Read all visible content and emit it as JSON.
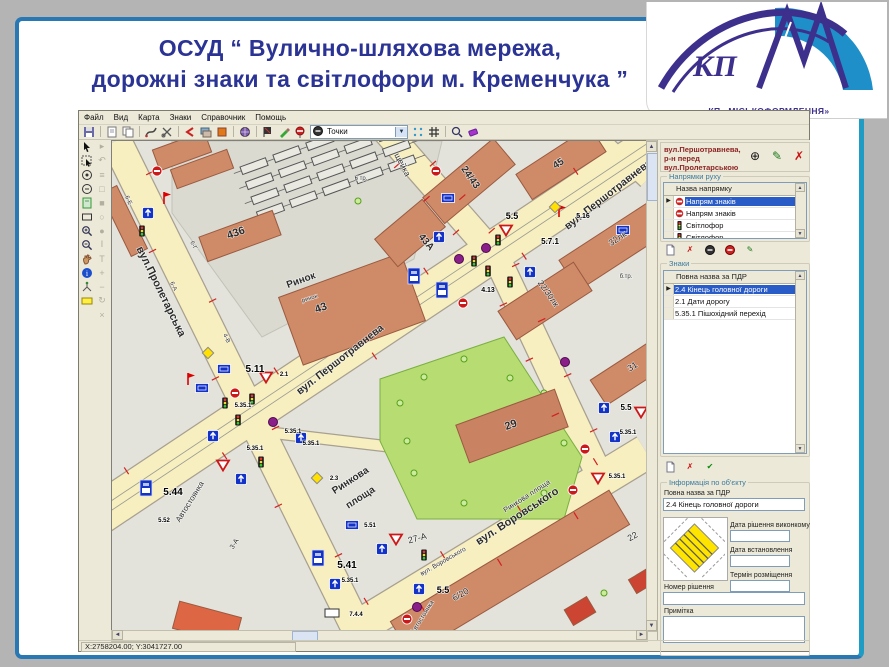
{
  "slide": {
    "title_line1": "ОСУД “ Вулично-шляхова мережа,",
    "title_line2": "дорожні знаки та світлофори м. Кременчука ”"
  },
  "logo": {
    "kp": "КП",
    "caption": "КП «МІСЬКОФОРМЛЕННЯ»",
    "purple": "#3d2f8c",
    "blue": "#1f8fc9"
  },
  "app": {
    "menu": [
      "Файл",
      "Вид",
      "Карта",
      "Знаки",
      "Справочник",
      "Помощь"
    ],
    "toolbar": {
      "combo_value": "Точки"
    },
    "statusbar": "X:2758204.00; Y:3041727.00",
    "panel": {
      "header": "вул.Першотравнева, р-н перед вул.Пролетарською",
      "directions": {
        "group_label": "Напрямки руху",
        "column": "Назва напрямку",
        "rows": [
          {
            "icon": "no-entry",
            "label": "Напрям знаків",
            "selected": true
          },
          {
            "icon": "no-entry",
            "label": "Напрям знаків",
            "selected": false
          },
          {
            "icon": "traffic-light",
            "label": "Світлофор",
            "selected": false
          },
          {
            "icon": "traffic-light",
            "label": "Світлофор",
            "selected": false
          }
        ]
      },
      "signs": {
        "group_label": "Знаки",
        "column": "Повна назва за ПДР",
        "rows": [
          {
            "icon": "",
            "label": "2.4 Кінець головної дороги",
            "selected": true
          },
          {
            "icon": "",
            "label": "2.1 Дати дорогу",
            "selected": false
          },
          {
            "icon": "",
            "label": "5.35.1 Пішохідний перехід",
            "selected": false
          }
        ]
      },
      "info": {
        "group_label": "Інформація по об'єкту",
        "full_name_label": "Повна назва за ПДР",
        "full_name_value": "2.4 Кінець головної дороги",
        "date_fields": [
          {
            "label": "Дата рішення виконкому",
            "value": ""
          },
          {
            "label": "Дата встановлення",
            "value": ""
          },
          {
            "label": "Термін розміщення",
            "value": ""
          }
        ],
        "decision_label": "Номер рішення",
        "decision_value": "",
        "note_label": "Примітка",
        "note_value": ""
      }
    },
    "map": {
      "street_labels": [
        {
          "text": "вул. Першотравнева",
          "x": 498,
          "y": 56,
          "rot": -38,
          "size": 10.5
        },
        {
          "text": "вул. Першотравнева",
          "x": 230,
          "y": 221,
          "rot": -38,
          "size": 10.5
        },
        {
          "text": "вул.Пролетарська",
          "x": 46,
          "y": 152,
          "rot": 64,
          "size": 11
        },
        {
          "text": "щейка",
          "x": 288,
          "y": 25,
          "rot": 62,
          "size": 8.5
        },
        {
          "text": "вул. Воровського",
          "x": 407,
          "y": 378,
          "rot": -33,
          "size": 11
        },
        {
          "text": "вул. Воровського",
          "x": 332,
          "y": 422,
          "rot": -30,
          "size": 6.5
        }
      ],
      "area_labels": [
        {
          "text": "436",
          "x": 125,
          "y": 95,
          "rot": -20,
          "size": 11
        },
        {
          "text": "Ринок",
          "x": 190,
          "y": 142,
          "rot": -20,
          "size": 10
        },
        {
          "text": "ринок",
          "x": 198,
          "y": 159,
          "rot": -18,
          "size": 6
        },
        {
          "text": "43",
          "x": 210,
          "y": 170,
          "rot": -20,
          "size": 11
        },
        {
          "text": "43А",
          "x": 312,
          "y": 103,
          "rot": 50,
          "size": 10
        },
        {
          "text": "24/43",
          "x": 356,
          "y": 38,
          "rot": 55,
          "size": 10
        },
        {
          "text": "45",
          "x": 448,
          "y": 25,
          "rot": -33,
          "size": 10
        },
        {
          "text": "32лк",
          "x": 507,
          "y": 100,
          "rot": -33,
          "size": 9
        },
        {
          "text": "22/30лк",
          "x": 434,
          "y": 154,
          "rot": 55,
          "size": 8.5
        },
        {
          "text": "31",
          "x": 522,
          "y": 228,
          "rot": -33,
          "size": 9
        },
        {
          "text": "29",
          "x": 400,
          "y": 287,
          "rot": -20,
          "size": 11
        },
        {
          "text": "27-А",
          "x": 306,
          "y": 400,
          "rot": -15,
          "size": 9
        },
        {
          "text": "6/20",
          "x": 350,
          "y": 456,
          "rot": -30,
          "size": 9
        },
        {
          "text": "22",
          "x": 522,
          "y": 398,
          "rot": -30,
          "size": 9
        },
        {
          "text": "6 тр.",
          "x": 249,
          "y": 39,
          "rot": 0,
          "size": 6
        },
        {
          "text": "б.тр.",
          "x": 514,
          "y": 137,
          "rot": 0,
          "size": 6
        },
        {
          "text": "6-Е",
          "x": 15,
          "y": 60,
          "rot": 64,
          "size": 6
        },
        {
          "text": "6-Г",
          "x": 80,
          "y": 105,
          "rot": 64,
          "size": 6
        },
        {
          "text": "6-А",
          "x": 60,
          "y": 146,
          "rot": 64,
          "size": 6
        },
        {
          "text": "4-В",
          "x": 113,
          "y": 198,
          "rot": 64,
          "size": 6
        },
        {
          "text": "3-А",
          "x": 124,
          "y": 404,
          "rot": -58,
          "size": 7
        },
        {
          "text": "Автостоянка",
          "x": 80,
          "y": 362,
          "rot": -58,
          "size": 8
        },
        {
          "text": "Автостоянка",
          "x": 312,
          "y": 477,
          "rot": -58,
          "size": 6.5
        },
        {
          "text": "Ринкова",
          "x": 240,
          "y": 342,
          "rot": -33,
          "size": 10
        },
        {
          "text": "площа",
          "x": 250,
          "y": 359,
          "rot": -33,
          "size": 10
        },
        {
          "text": "Ринкова площа",
          "x": 416,
          "y": 357,
          "rot": -33,
          "size": 7.5
        }
      ],
      "sign_labels": [
        {
          "text": "5.5",
          "x": 400,
          "y": 78,
          "size": 9
        },
        {
          "text": "5.7.1",
          "x": 438,
          "y": 103,
          "size": 8
        },
        {
          "text": "5.16",
          "x": 471,
          "y": 77,
          "size": 7
        },
        {
          "text": "4.13",
          "x": 376,
          "y": 151,
          "size": 7
        },
        {
          "text": "5.11",
          "x": 143,
          "y": 231,
          "size": 10
        },
        {
          "text": "2.1",
          "x": 172,
          "y": 235,
          "size": 6
        },
        {
          "text": "5.35.1",
          "x": 131,
          "y": 266,
          "size": 6
        },
        {
          "text": "5.35.1",
          "x": 181,
          "y": 292,
          "size": 6
        },
        {
          "text": "5.35.1",
          "x": 199,
          "y": 304,
          "size": 6
        },
        {
          "text": "5.35.1",
          "x": 143,
          "y": 309,
          "size": 6
        },
        {
          "text": "5.41",
          "x": 235,
          "y": 427,
          "size": 10
        },
        {
          "text": "5.35.1",
          "x": 238,
          "y": 441,
          "size": 6
        },
        {
          "text": "7.4.4",
          "x": 244,
          "y": 475,
          "size": 6
        },
        {
          "text": "5.5",
          "x": 331,
          "y": 452,
          "size": 9
        },
        {
          "text": "5.51",
          "x": 258,
          "y": 386,
          "size": 6
        },
        {
          "text": "2.3",
          "x": 222,
          "y": 339,
          "size": 6
        },
        {
          "text": "5.44",
          "x": 61,
          "y": 354,
          "size": 10
        },
        {
          "text": "5.52",
          "x": 52,
          "y": 381,
          "size": 6
        },
        {
          "text": "5.5",
          "x": 514,
          "y": 269,
          "size": 8
        },
        {
          "text": "5.35.1",
          "x": 516,
          "y": 293,
          "size": 6
        },
        {
          "text": "5.35.1",
          "x": 505,
          "y": 337,
          "size": 6
        }
      ],
      "signs": [
        {
          "t": "noentry",
          "x": 324,
          "y": 30
        },
        {
          "t": "bluerect",
          "x": 336,
          "y": 57
        },
        {
          "t": "bluearrow",
          "x": 327,
          "y": 96
        },
        {
          "t": "yield",
          "x": 394,
          "y": 89
        },
        {
          "t": "tlight",
          "x": 386,
          "y": 99
        },
        {
          "t": "tlight",
          "x": 362,
          "y": 120
        },
        {
          "t": "purple",
          "x": 374,
          "y": 107
        },
        {
          "t": "purple",
          "x": 347,
          "y": 118
        },
        {
          "t": "redflag",
          "x": 447,
          "y": 70
        },
        {
          "t": "bluerect",
          "x": 511,
          "y": 89
        },
        {
          "t": "busstop",
          "x": 302,
          "y": 135
        },
        {
          "t": "busstop",
          "x": 330,
          "y": 149
        },
        {
          "t": "noentry",
          "x": 351,
          "y": 162
        },
        {
          "t": "tlight",
          "x": 398,
          "y": 141
        },
        {
          "t": "bluearrow",
          "x": 418,
          "y": 131
        },
        {
          "t": "yellowdiamond",
          "x": 443,
          "y": 66
        },
        {
          "t": "noentry",
          "x": 45,
          "y": 30
        },
        {
          "t": "bluearrow",
          "x": 36,
          "y": 72
        },
        {
          "t": "redflag",
          "x": 52,
          "y": 57
        },
        {
          "t": "tlight",
          "x": 30,
          "y": 90
        },
        {
          "t": "bluerect",
          "x": 112,
          "y": 228
        },
        {
          "t": "bluerect",
          "x": 90,
          "y": 247
        },
        {
          "t": "noentry",
          "x": 123,
          "y": 252
        },
        {
          "t": "yield",
          "x": 154,
          "y": 236
        },
        {
          "t": "tlight",
          "x": 113,
          "y": 262
        },
        {
          "t": "tlight",
          "x": 140,
          "y": 258
        },
        {
          "t": "tlight",
          "x": 126,
          "y": 279
        },
        {
          "t": "purple",
          "x": 161,
          "y": 281
        },
        {
          "t": "bluearrow",
          "x": 189,
          "y": 297
        },
        {
          "t": "bluearrow",
          "x": 101,
          "y": 295
        },
        {
          "t": "tlight",
          "x": 149,
          "y": 321
        },
        {
          "t": "yield",
          "x": 111,
          "y": 324
        },
        {
          "t": "bluearrow",
          "x": 129,
          "y": 338
        },
        {
          "t": "yellowdiamond",
          "x": 96,
          "y": 212
        },
        {
          "t": "redflag",
          "x": 76,
          "y": 238
        },
        {
          "t": "busstop",
          "x": 206,
          "y": 417
        },
        {
          "t": "bluearrow",
          "x": 223,
          "y": 443
        },
        {
          "t": "whiterect",
          "x": 220,
          "y": 472
        },
        {
          "t": "bluearrow",
          "x": 307,
          "y": 448
        },
        {
          "t": "purple",
          "x": 305,
          "y": 466
        },
        {
          "t": "bluerect",
          "x": 240,
          "y": 384
        },
        {
          "t": "yellowdiamond",
          "x": 205,
          "y": 337
        },
        {
          "t": "busstop",
          "x": 34,
          "y": 347
        },
        {
          "t": "tlight",
          "x": 312,
          "y": 414
        },
        {
          "t": "yield",
          "x": 284,
          "y": 398
        },
        {
          "t": "bluearrow",
          "x": 270,
          "y": 408
        },
        {
          "t": "noentry",
          "x": 295,
          "y": 478
        },
        {
          "t": "bluearrow",
          "x": 492,
          "y": 267
        },
        {
          "t": "yield",
          "x": 529,
          "y": 271
        },
        {
          "t": "bluearrow",
          "x": 503,
          "y": 296
        },
        {
          "t": "noentry",
          "x": 473,
          "y": 308
        },
        {
          "t": "purple",
          "x": 453,
          "y": 221
        },
        {
          "t": "noentry",
          "x": 461,
          "y": 349
        },
        {
          "t": "yield",
          "x": 486,
          "y": 337
        },
        {
          "t": "tlight",
          "x": 376,
          "y": 130
        }
      ]
    }
  }
}
